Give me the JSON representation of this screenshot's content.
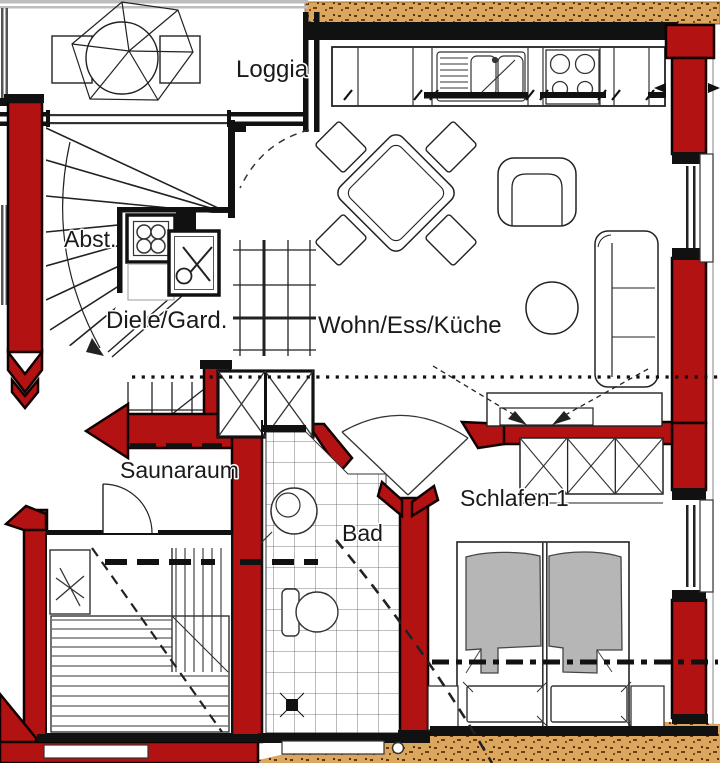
{
  "title": "Apartment floor plan",
  "rooms": {
    "loggia": "Loggia",
    "abst": "Abst.",
    "diele": "Diele/Gard.",
    "wohn": "Wohn/Ess/Küche",
    "sauna": "Saunaraum",
    "bad": "Bad",
    "schlafen": "Schlafen 1"
  },
  "colors": {
    "wall_red": "#b31212",
    "wall_black": "#111111",
    "terrain_sand": "#d9a75e",
    "duvet_gray": "#b6b6b6",
    "line": "#222222"
  }
}
